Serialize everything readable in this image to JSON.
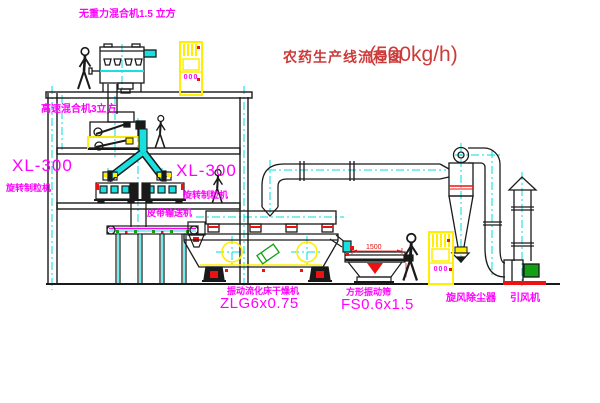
{
  "title": {
    "name": "农药生产线流程图",
    "capacity": "(500kg/h)"
  },
  "equipment_labels": {
    "top_mixer": "无重力混合机1.5 立方",
    "floor2_mixer": "高速混合机3立方",
    "granulator_left": {
      "model": "XL-300",
      "name": "旋转制粒机"
    },
    "granulator_right": {
      "model": "XL-300",
      "name": "旋转制粒机"
    },
    "belt_conveyor": "皮带输送机",
    "fluid_bed_dryer": {
      "name": "振动流化床干燥机",
      "model": "ZLG6x0.75"
    },
    "vibrating_sieve": {
      "name": "方形振动筛",
      "model": "FS0.6x1.5"
    },
    "cyclone": "旋风除尘器",
    "induced_draft_fan": "引风机"
  },
  "annotations": {
    "sieve_width_dim": "1500",
    "cabinet_display": "000"
  },
  "colors": {
    "line": "#1a1a1a",
    "centerline": "#00dcdc",
    "label_magenta": "#ff00ff",
    "title_red": "#cd3a3a",
    "accent_yellow": "#ffee00",
    "accent_red": "#ee1111",
    "accent_green": "#14a014",
    "pipe_cyan": "#19e0e0"
  }
}
